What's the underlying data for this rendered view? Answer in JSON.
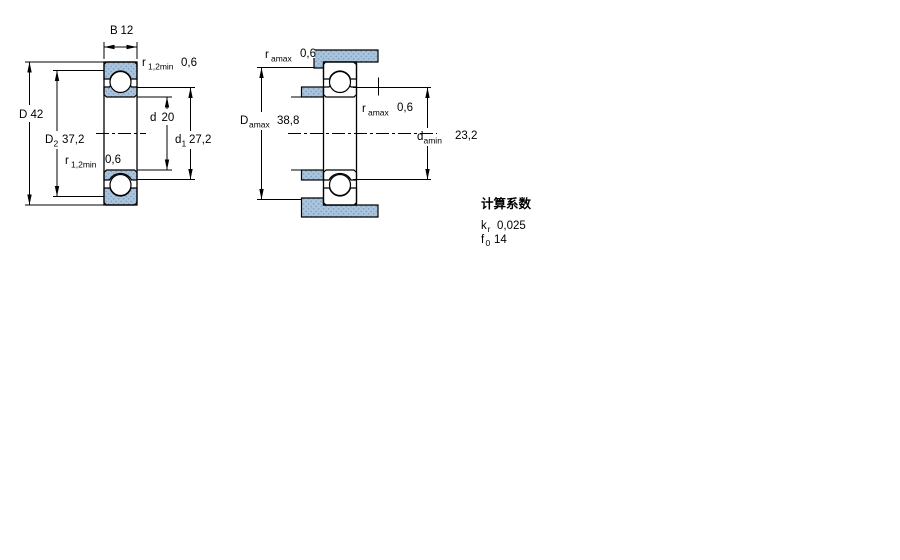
{
  "drawing": {
    "type": "deep groove ball bearing — section and abutment dimension drawing",
    "left_view": {
      "name": "bearing-cross-section",
      "dims": {
        "B": {
          "symbol": "B",
          "sub": "",
          "value": "12"
        },
        "D": {
          "symbol": "D",
          "sub": "",
          "value": "42"
        },
        "D2": {
          "symbol": "D",
          "sub": "2",
          "value": "37,2"
        },
        "d": {
          "symbol": "d",
          "sub": "",
          "value": "20"
        },
        "d1": {
          "symbol": "d",
          "sub": "1",
          "value": "27,2"
        },
        "r12_top": {
          "symbol": "r",
          "sub": "1,2min",
          "value": "0,6"
        },
        "r12_bot": {
          "symbol": "r",
          "sub": "1,2min",
          "value": "0,6"
        }
      }
    },
    "right_view": {
      "name": "abutment-dimensions",
      "dims": {
        "ra_top": {
          "symbol": "r",
          "sub": "amax",
          "value": "0,6"
        },
        "Da": {
          "symbol": "D",
          "sub": "amax",
          "value": "38,8"
        },
        "ra_mid": {
          "symbol": "r",
          "sub": "amax",
          "value": "0,6"
        },
        "da": {
          "symbol": "d",
          "sub": "amin",
          "value": "23,2"
        }
      }
    },
    "calculation_factors": {
      "heading": "计算系数",
      "rows": [
        {
          "symbol": "k",
          "sub": "r",
          "value": "0,025"
        },
        {
          "symbol": "f",
          "sub": "0",
          "value": "14"
        }
      ]
    },
    "colors": {
      "section_fill": "#a9c4dc",
      "section_dot": "#7d9fc0",
      "line": "#000000",
      "background": "#ffffff"
    }
  }
}
